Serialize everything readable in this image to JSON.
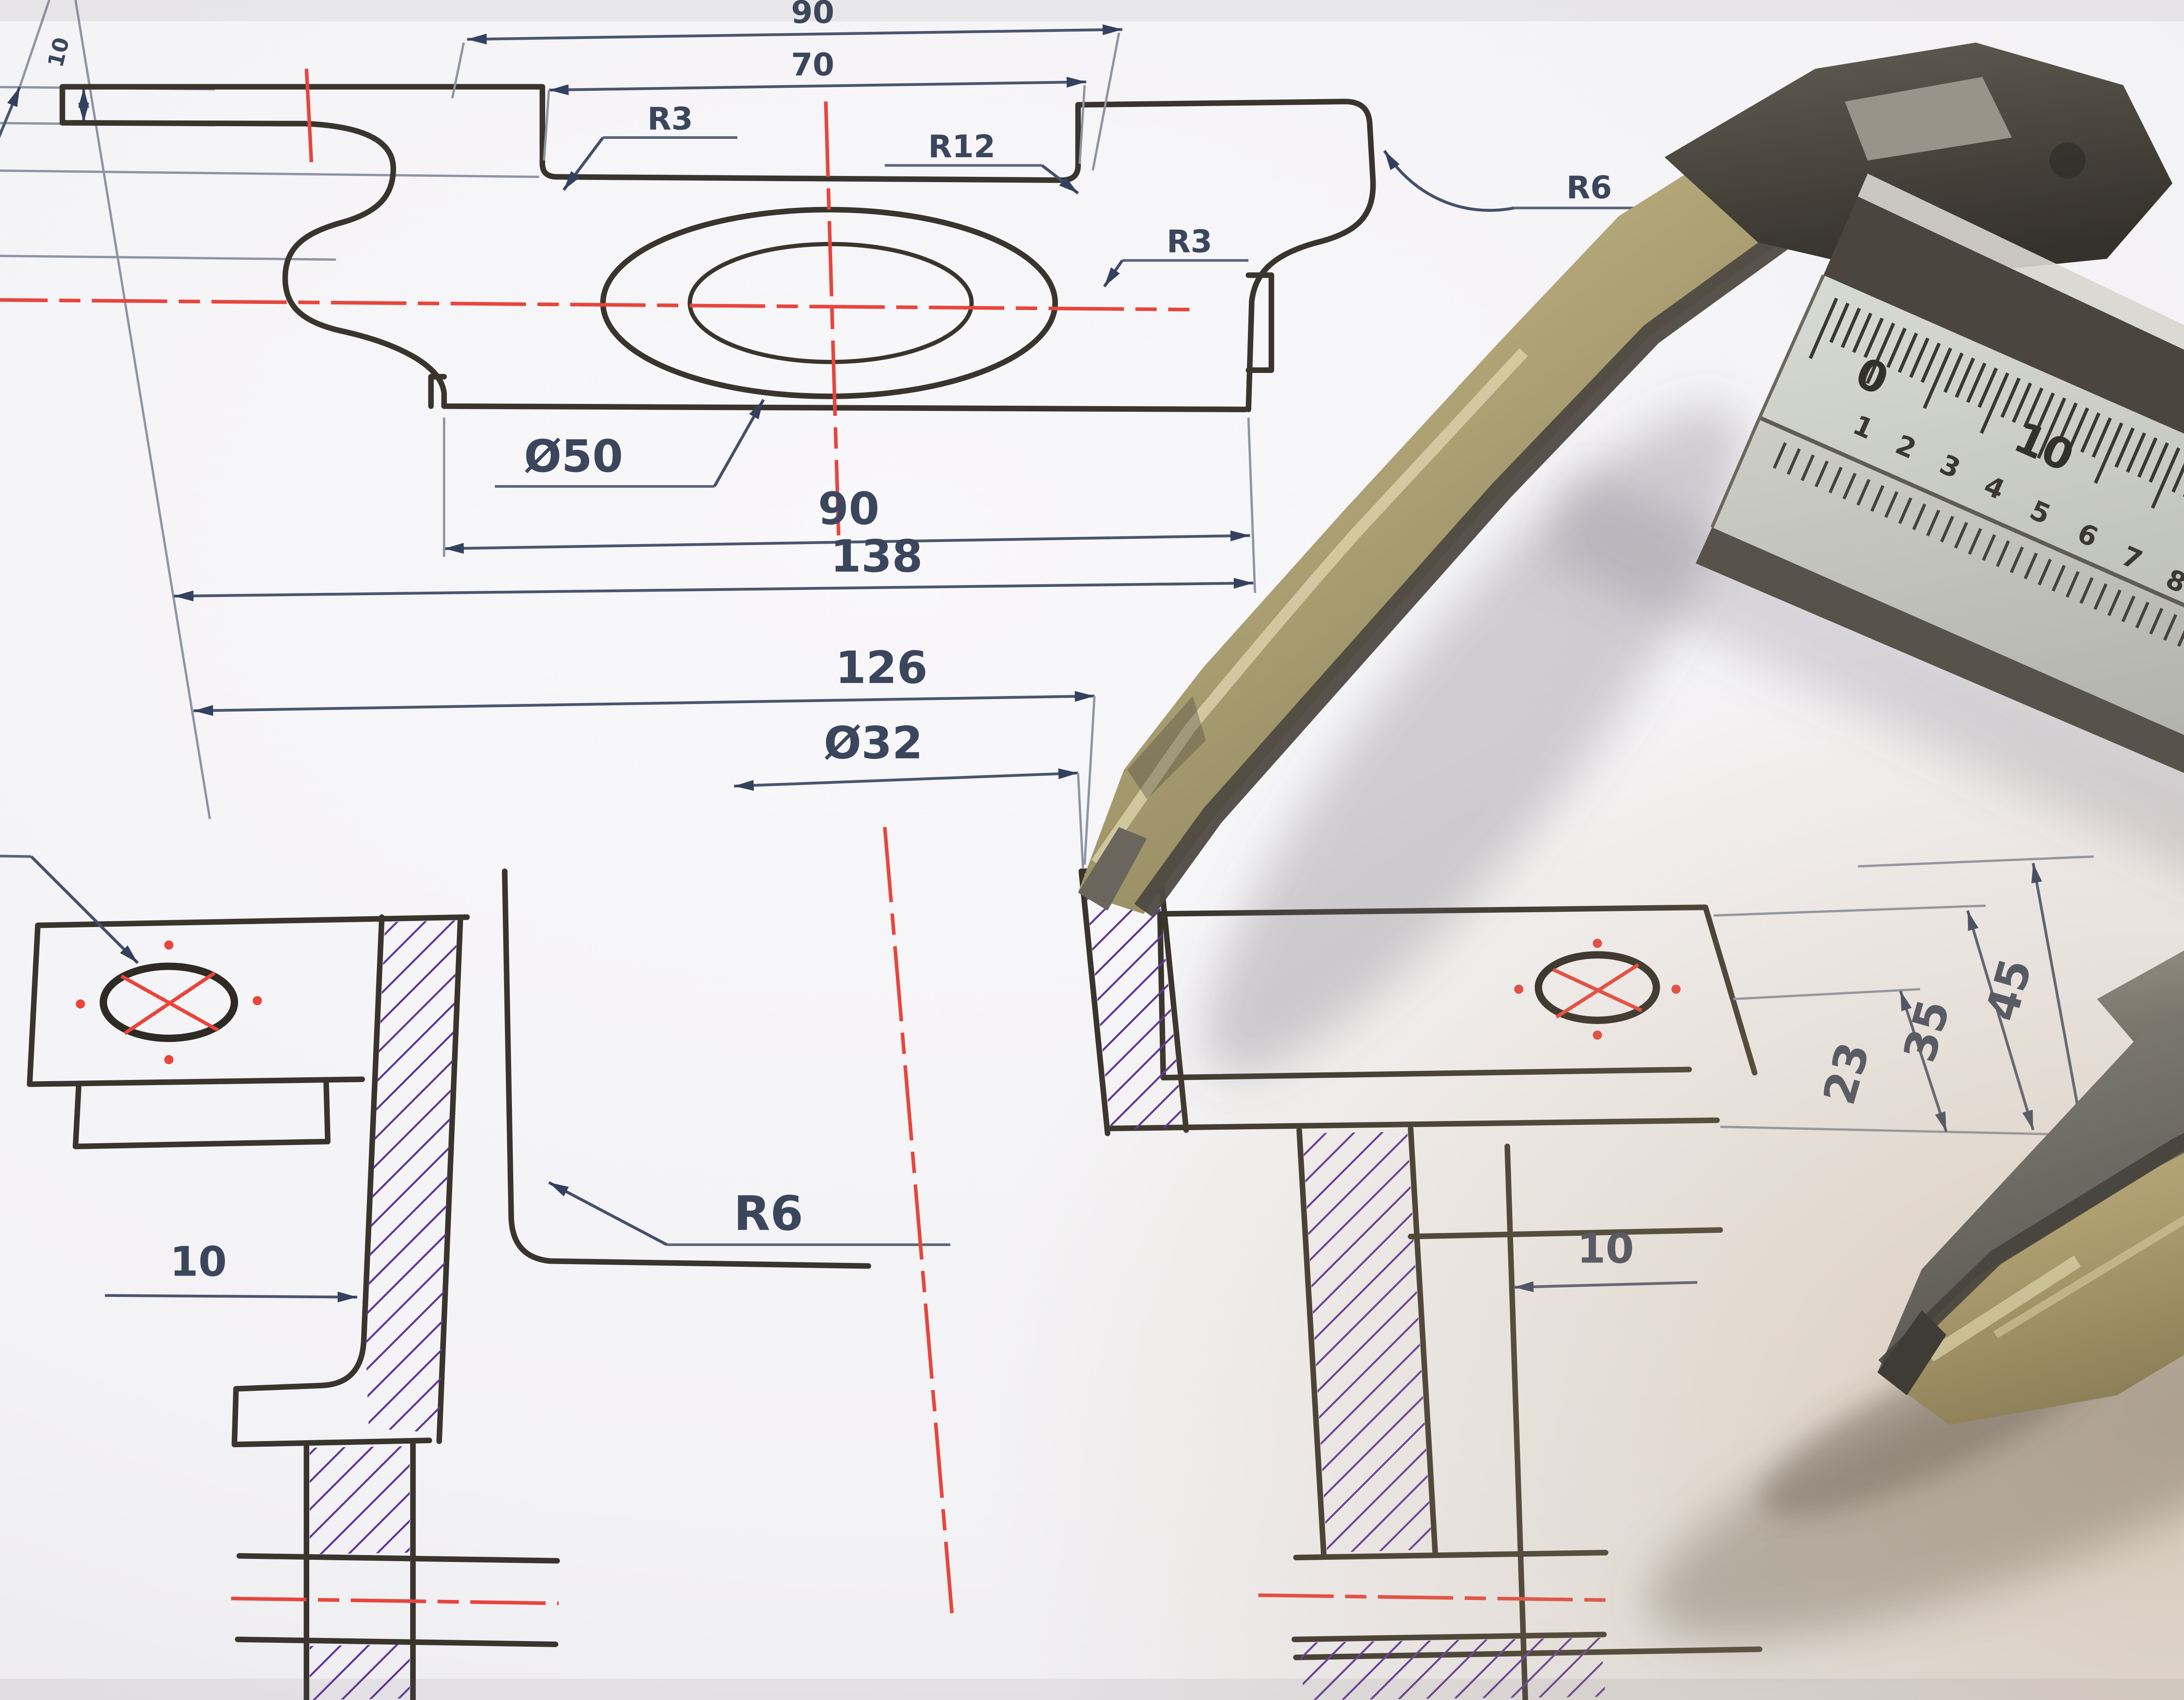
{
  "scene": {
    "description": "vernier caliper lying on a technical engineering drawing",
    "paper_color": "#f6f5f7"
  },
  "colors": {
    "outline": "#3a352c",
    "dimension": "#4a5570",
    "centerline": "#e8453c",
    "hatch": "#5f3699",
    "label_text": "#3b465c",
    "brass": "#b3a478",
    "steel": "#8f8c83"
  },
  "margin_dims": {
    "d40": "40",
    "d25": "25",
    "d10": "10"
  },
  "top_view": {
    "w90": "90",
    "w70": "70",
    "r3a": "R3",
    "r12": "R12",
    "r3b": "R3",
    "r6": "R6",
    "bore": "Ø50",
    "w90b": "90",
    "w138": "138"
  },
  "section_view": {
    "w126": "126",
    "bore": "Ø32",
    "holes": "10(2x)",
    "r6": "R6",
    "wall10L": "10",
    "wall10R": "10",
    "h23": "23",
    "h35": "35",
    "h45": "45"
  },
  "caliper": {
    "vernier": {
      "v0": "0",
      "v10": "10",
      "v20": "20"
    },
    "beam_digits": [
      "1",
      "2",
      "3",
      "4",
      "5",
      "6",
      "7",
      "8",
      "9",
      "1"
    ]
  }
}
